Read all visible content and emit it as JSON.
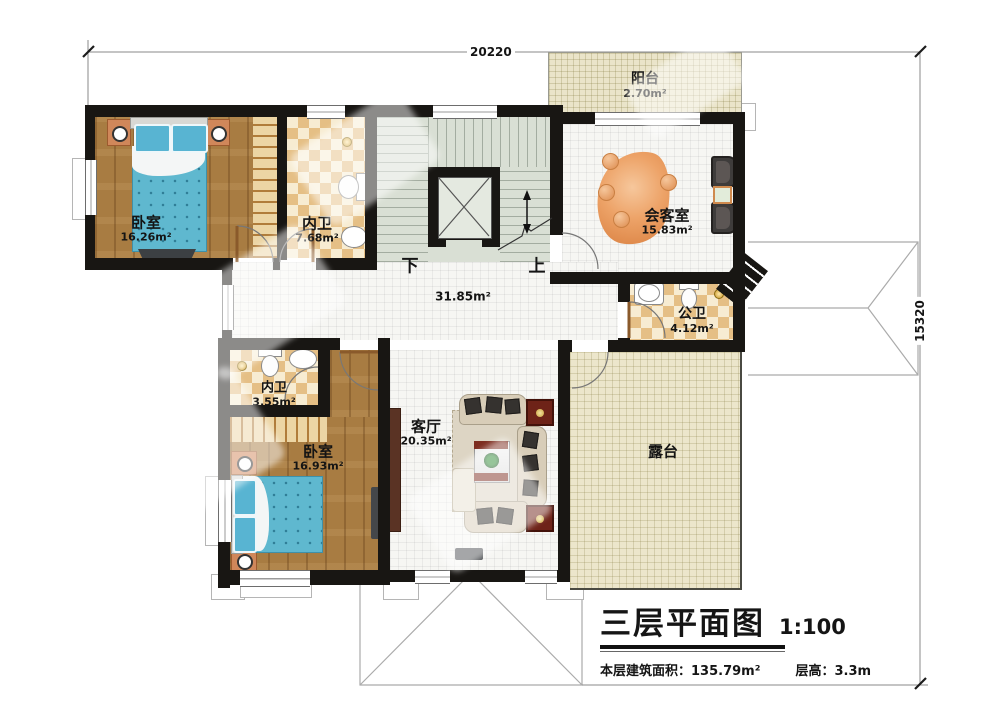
{
  "dimensions": {
    "top": "20220",
    "right": "15320"
  },
  "stairs": {
    "down": "下",
    "up": "上"
  },
  "rooms": {
    "balcony": {
      "name": "阳台",
      "area": "2.70m²"
    },
    "bedroom_top": {
      "name": "卧室",
      "area": "16.26m²"
    },
    "bath_top": {
      "name": "内卫",
      "area": "7.68m²"
    },
    "reception": {
      "name": "会客室",
      "area": "15.83m²"
    },
    "public_bath": {
      "name": "公卫",
      "area": "4.12m²"
    },
    "hall": {
      "area": "31.85m²"
    },
    "bath_bottom": {
      "name": "内卫",
      "area": "3.55m²"
    },
    "bedroom_bottom": {
      "name": "卧室",
      "area": "16.93m²"
    },
    "living": {
      "name": "客厅",
      "area": "20.35m²"
    },
    "terrace": {
      "name": "露台"
    }
  },
  "title": {
    "main": "三层平面图",
    "scale": "1:100",
    "floor_area_label": "本层建筑面积：",
    "floor_area_value": "135.79m²",
    "storey_label": "层高：",
    "storey_value": "3.3m"
  },
  "colors": {
    "wall": "#181613",
    "wood_floor": "#a87c42",
    "tile_checker_dark": "#e5bf85",
    "stair_floor": "#d9dfd4",
    "terrace_floor": "#ece6cb",
    "bed_blue": "#5fb8cf",
    "rug_orange": "#e09055"
  }
}
